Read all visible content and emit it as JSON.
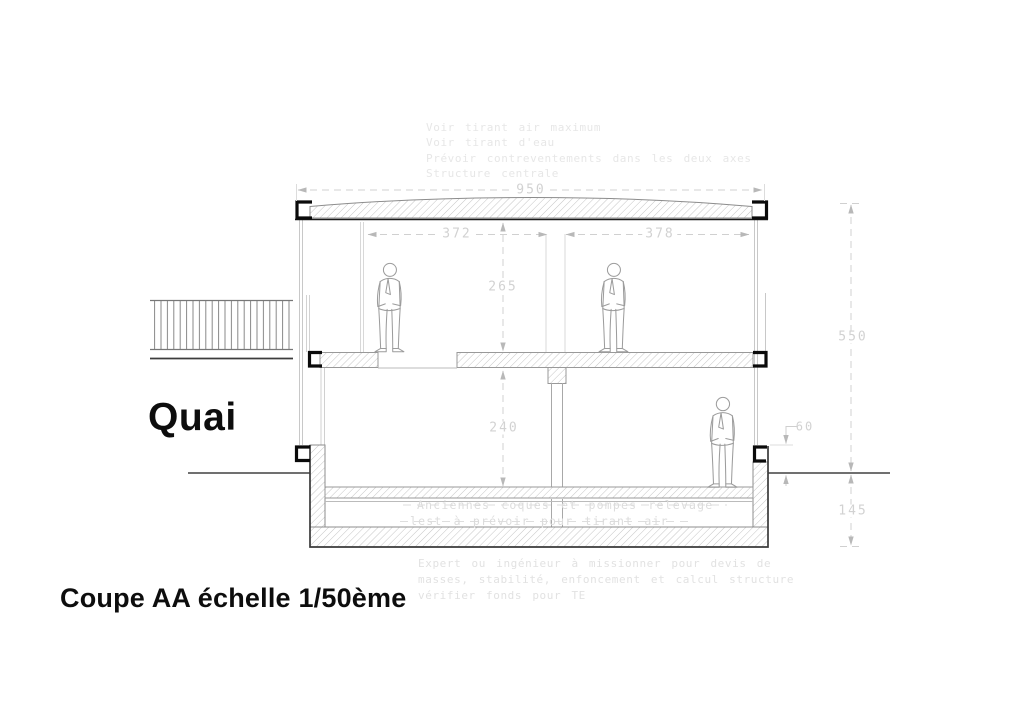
{
  "page": {
    "quai_label": "Quai",
    "caption": "Coupe AA échelle 1/50ème",
    "notes_top": [
      "Voir tirant air maximum",
      "Voir tirant d'eau",
      "Prévoir contreventements dans les deux axes",
      "Structure centrale"
    ],
    "bilge_notes": [
      "Anciennes coques et pompes relevage",
      "lest à prévoir pour tirant air"
    ],
    "notes_bottom": [
      "Expert ou ingénieur à missionner pour devis de",
      "masses, stabilité, enfoncement et calcul structure",
      "vérifier fonds pour TE"
    ],
    "dimensions": {
      "overall_width": "950",
      "left_bay_width": "372",
      "right_bay_width": "378",
      "upper_deck_height": "265",
      "lower_deck_height": "240",
      "overall_height": "550",
      "freeboard": "60",
      "draught": "145"
    },
    "colors": {
      "ink_black": "#141414",
      "structure_gray": "#8c8c8c",
      "light_line_gray": "#c8c8c8",
      "hatch_gray": "#bfbfbf",
      "dimension_gray": "#d2d2d2",
      "note_gray": "#e5e5e5",
      "background": "#ffffff"
    }
  }
}
